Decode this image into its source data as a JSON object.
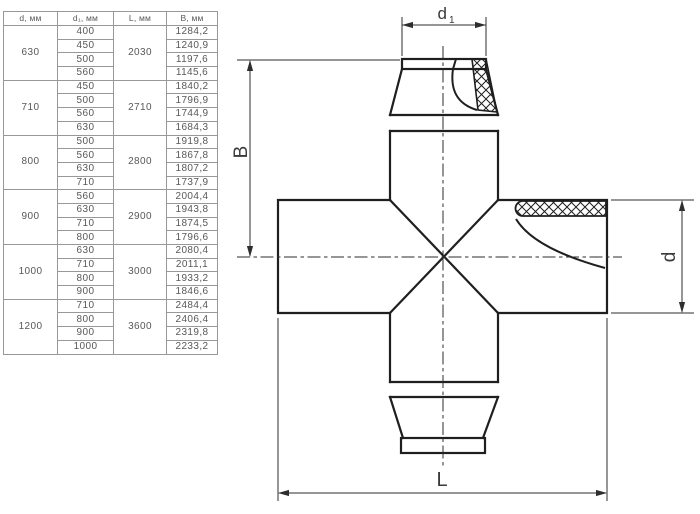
{
  "table": {
    "headers": [
      "d, мм",
      "d₁, мм",
      "L, мм",
      "B, мм"
    ],
    "groups": [
      {
        "d": "630",
        "L": "2030",
        "rows": [
          [
            "400",
            "1284,2"
          ],
          [
            "450",
            "1240,9"
          ],
          [
            "500",
            "1197,6"
          ],
          [
            "560",
            "1145,6"
          ]
        ]
      },
      {
        "d": "710",
        "L": "2710",
        "rows": [
          [
            "450",
            "1840,2"
          ],
          [
            "500",
            "1796,9"
          ],
          [
            "560",
            "1744,9"
          ],
          [
            "630",
            "1684,3"
          ]
        ]
      },
      {
        "d": "800",
        "L": "2800",
        "rows": [
          [
            "500",
            "1919,8"
          ],
          [
            "560",
            "1867,8"
          ],
          [
            "630",
            "1807,2"
          ],
          [
            "710",
            "1737,9"
          ]
        ]
      },
      {
        "d": "900",
        "L": "2900",
        "rows": [
          [
            "560",
            "2004,4"
          ],
          [
            "630",
            "1943,8"
          ],
          [
            "710",
            "1874,5"
          ],
          [
            "800",
            "1796,6"
          ]
        ]
      },
      {
        "d": "1000",
        "L": "3000",
        "rows": [
          [
            "630",
            "2080,4"
          ],
          [
            "710",
            "2011,1"
          ],
          [
            "800",
            "1933,2"
          ],
          [
            "900",
            "1846,6"
          ]
        ]
      },
      {
        "d": "1200",
        "L": "3600",
        "rows": [
          [
            "710",
            "2484,4"
          ],
          [
            "800",
            "2406,4"
          ],
          [
            "900",
            "2319,8"
          ],
          [
            "1000",
            "2233,2"
          ]
        ]
      }
    ]
  },
  "diagram": {
    "labels": {
      "d1_main": "d",
      "d1_sub": "1",
      "B": "B",
      "d": "d",
      "L": "L"
    },
    "colors": {
      "outline": "#1f1f1f",
      "dimension": "#2e2e2e",
      "table_border": "#98989b",
      "table_text": "#58585a",
      "background": "#ffffff"
    }
  }
}
